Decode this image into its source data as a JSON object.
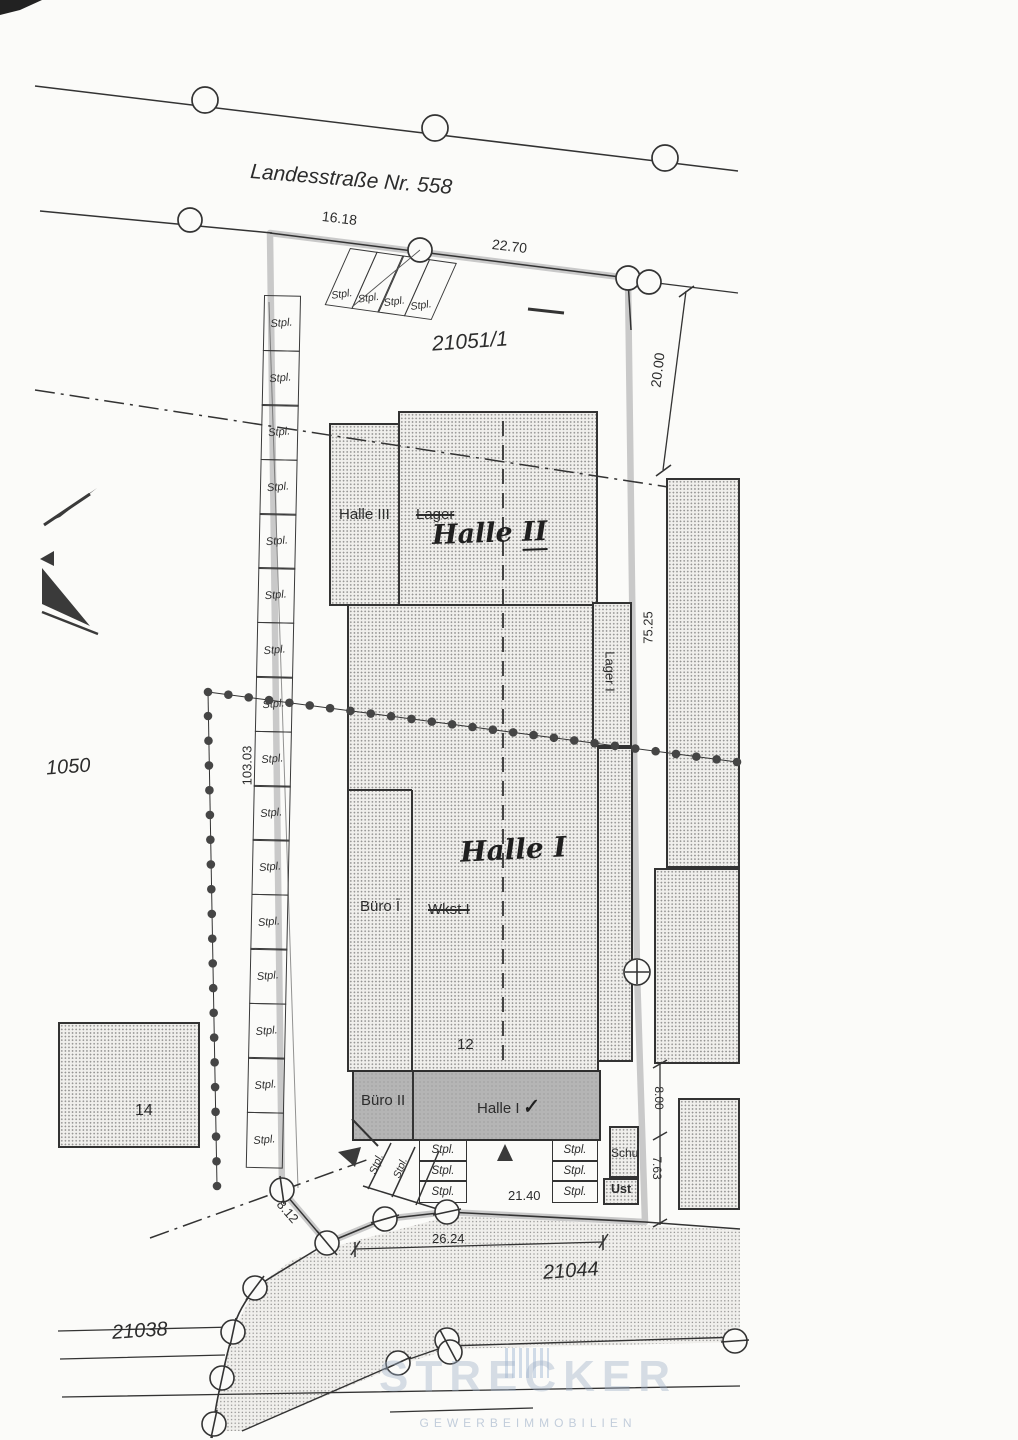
{
  "street": {
    "name": "Landesstraße Nr. 558"
  },
  "parcels": {
    "main": "21051/1",
    "west": "1050",
    "south": "21044",
    "southwest": "21038"
  },
  "house_numbers": {
    "main": "12",
    "west": "14"
  },
  "buildings": {
    "halle3": "Halle III",
    "lager_old": "Lager",
    "halle2_hand": "Halle",
    "halle2_num": "II",
    "halle1_hand": "Halle",
    "halle1_num": "I",
    "buero1": "Büro Ī",
    "wkst_old": "Wkst I",
    "lager1": "Lager I",
    "buero2": "Büro II",
    "halle4": "Halle I",
    "halle4_mark": "✓",
    "schu": "Schu",
    "ust": "Ust"
  },
  "dimensions": {
    "front_left": "16.18",
    "front_right": "22.70",
    "ne_depth": "20.00",
    "east": "75.25",
    "west": "103.03",
    "sw": "8.12",
    "south_front": "21.40",
    "street_span": "26.24",
    "se_upper": "8.00",
    "se_lower": "7.63"
  },
  "parking": {
    "top_stalls": [
      "Stpl.",
      "Stpl.",
      "Stpl.",
      "Stpl."
    ],
    "west_stalls": [
      "Stpl.",
      "Stpl.",
      "Stpl.",
      "Stpl.",
      "Stpl.",
      "Stpl.",
      "Stpl.",
      "Stpl.",
      "Stpl.",
      "Stpl.",
      "Stpl.",
      "Stpl.",
      "Stpl.",
      "Stpl.",
      "Stpl.",
      "Stpl."
    ],
    "south_left_stalls": [
      "Stpl.",
      "Stpl.",
      "Stpl."
    ],
    "south_right_stalls": [
      "Stpl.",
      "Stpl.",
      "Stpl."
    ],
    "south_slanted_stalls": [
      "Stpl.",
      "Stpl."
    ]
  },
  "watermark": {
    "name": "STRECKER",
    "subtitle": "GEWERBEIMMOBILIEN"
  }
}
